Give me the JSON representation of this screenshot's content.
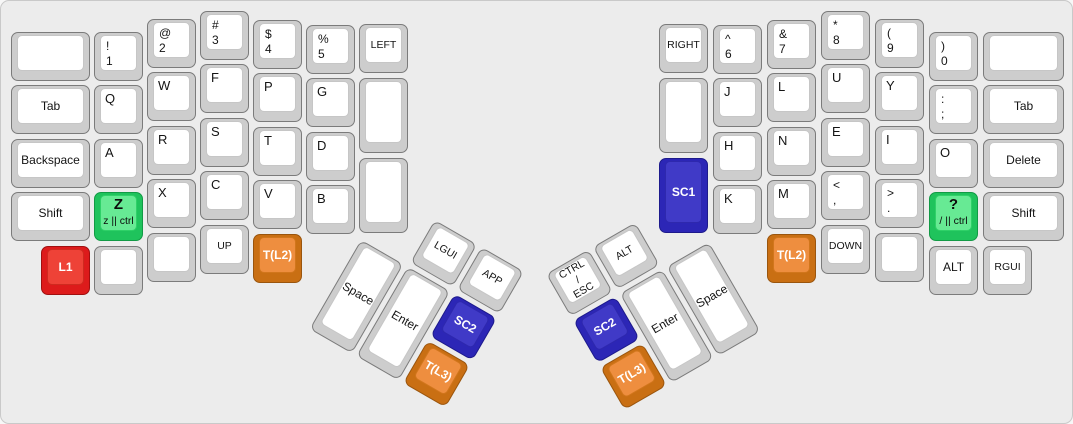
{
  "colors": {
    "panel_bg": "#ececec",
    "key_red": "#dd1b1b",
    "key_green": "#1fc35c",
    "key_blue": "#2c26b6",
    "key_orange": "#c96f13",
    "key_normal": "#ffffff"
  },
  "left": {
    "n1": {
      "t": "!",
      "b": "1"
    },
    "n2": {
      "t": "@",
      "b": "2"
    },
    "n3": {
      "t": "#",
      "b": "3"
    },
    "n4": {
      "t": "$",
      "b": "4"
    },
    "n5": {
      "t": "%",
      "b": "5"
    },
    "arrow_left": "LEFT",
    "tab": "Tab",
    "q": "Q",
    "w": "W",
    "f": "F",
    "p": "P",
    "g": "G",
    "backspace": "Backspace",
    "a": "A",
    "r": "R",
    "s": "S",
    "t": "T",
    "d": "D",
    "shift": "Shift",
    "z": {
      "main": "Z",
      "sub": "z || ctrl"
    },
    "x": "X",
    "c": "C",
    "v": "V",
    "b": "B",
    "l1": "L1",
    "up": "UP",
    "t_l2": "T(L2)",
    "thumb": {
      "lgui": "LGUI",
      "app": "APP",
      "space": "Space",
      "enter": "Enter",
      "sc2": "SC2",
      "t_l3": "T(L3)"
    }
  },
  "right": {
    "arrow_right": "RIGHT",
    "n6": {
      "t": "^",
      "b": "6"
    },
    "n7": {
      "t": "&",
      "b": "7"
    },
    "n8": {
      "t": "*",
      "b": "8"
    },
    "n9": {
      "t": "(",
      "b": "9"
    },
    "n0": {
      "t": ")",
      "b": "0"
    },
    "j": "J",
    "l": "L",
    "u": "U",
    "y": "Y",
    "semicolon": {
      "t": ":",
      "b": ";"
    },
    "tab": "Tab",
    "h": "H",
    "n": "N",
    "e": "E",
    "i": "I",
    "o": "O",
    "delete": "Delete",
    "sc1": "SC1",
    "k": "K",
    "m": "M",
    "comma": {
      "t": "<",
      "b": ","
    },
    "period": {
      "t": ">",
      "b": "."
    },
    "question": {
      "main": "?",
      "sub": "/ || ctrl"
    },
    "shift": "Shift",
    "t_l2": "T(L2)",
    "down": "DOWN",
    "alt": "ALT",
    "rgui": "RGUI",
    "thumb": {
      "ctrl_esc": "CTRL\n/\nESC",
      "alt": "ALT",
      "sc2": "SC2",
      "t_l3": "T(L3)",
      "enter": "Enter",
      "space": "Space"
    }
  }
}
